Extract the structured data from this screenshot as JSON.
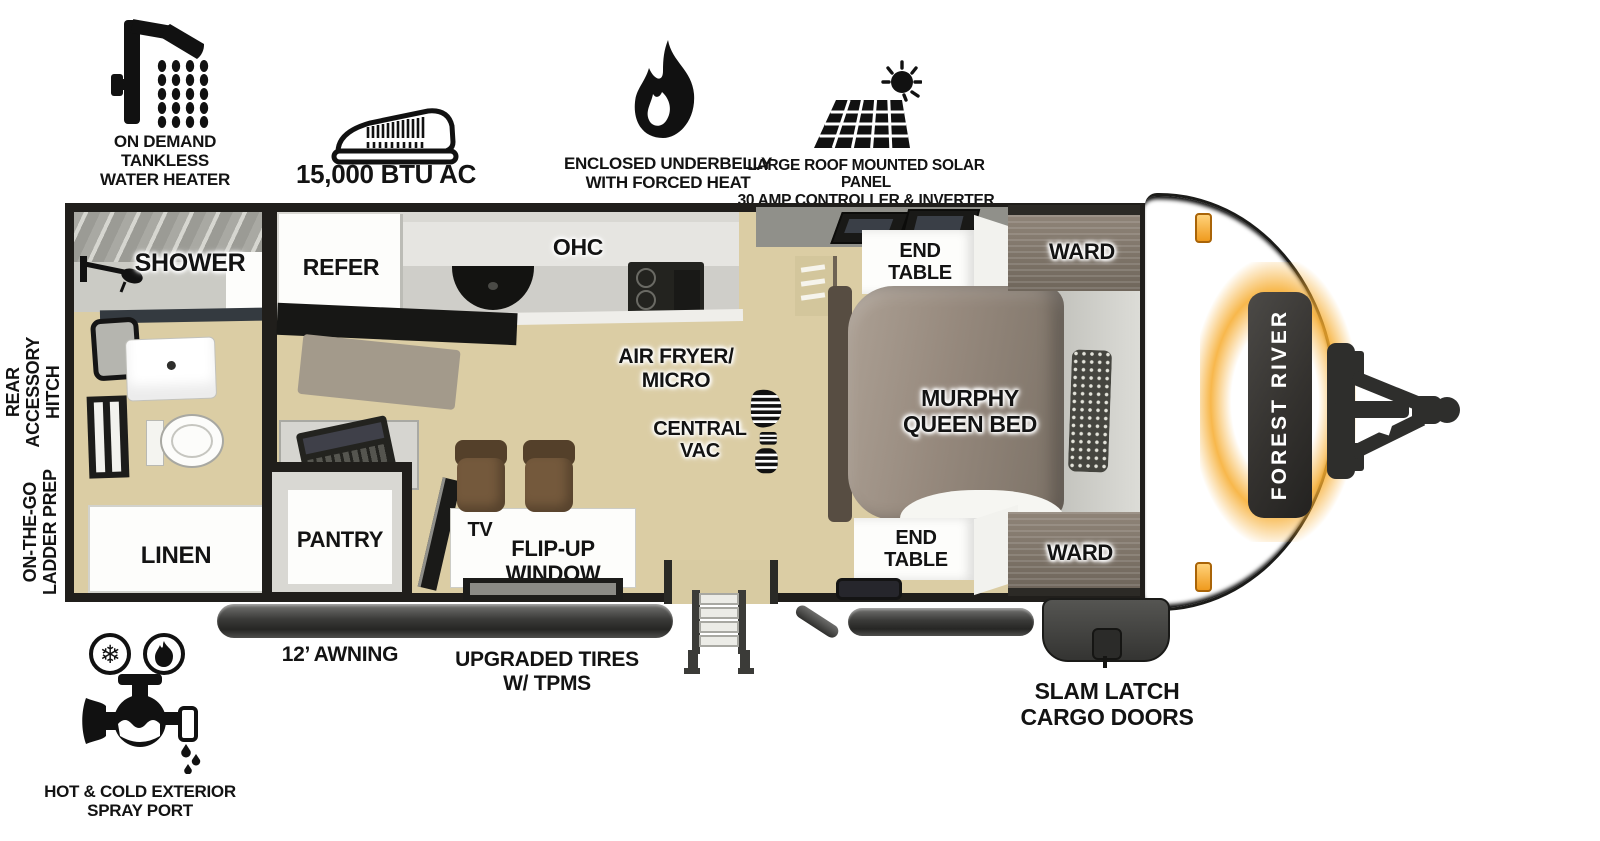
{
  "brand": "FOREST RIVER",
  "top_features": {
    "water_heater": {
      "icon": "shower-icon",
      "label": "ON DEMAND\nTANKLESS\nWATER HEATER"
    },
    "ac": {
      "icon": "rooftop-ac-icon",
      "label": "15,000 BTU AC"
    },
    "underbelly": {
      "icon": "flame-icon",
      "label": "ENCLOSED UNDERBELLY\nWITH FORCED HEAT"
    },
    "solar": {
      "icon": "solar-panel-icon",
      "label": "LARGE ROOF MOUNTED SOLAR PANEL\n30 AMP CONTROLLER & INVERTER PREP"
    }
  },
  "side_labels": {
    "rear_hitch": "REAR\nACCESSORY\nHITCH",
    "ladder_prep": "ON-THE-GO\nLADDER PREP"
  },
  "rooms": {
    "shower": "SHOWER",
    "linen": "LINEN",
    "refer": "REFER",
    "ohc": "OHC",
    "air_fryer_micro": "AIR FRYER/\nMICRO",
    "central_vac": "CENTRAL\nVAC",
    "pantry": "PANTRY",
    "tv": "TV",
    "flip_up_window": "FLIP-UP\nWINDOW",
    "murphy_bed": "MURPHY\nQUEEN BED",
    "end_table_top": "END\nTABLE",
    "end_table_bottom": "END\nTABLE",
    "ward_top": "WARD",
    "ward_bottom": "WARD"
  },
  "bottom": {
    "awning": "12’ AWNING",
    "tires": "UPGRADED TIRES\nW/ TPMS",
    "cargo_doors": "SLAM LATCH\nCARGO DOORS",
    "spray_port": {
      "icon": "faucet-icon",
      "label": "HOT & COLD EXTERIOR\nSPRAY PORT"
    }
  },
  "colors": {
    "floor_wood": "#dbcda4",
    "accent_amber": "#f5a93c",
    "ink": "#131313",
    "cabinet_wood": "#8f8478",
    "bed": "#95897d",
    "stool_brown": "#74593c"
  }
}
